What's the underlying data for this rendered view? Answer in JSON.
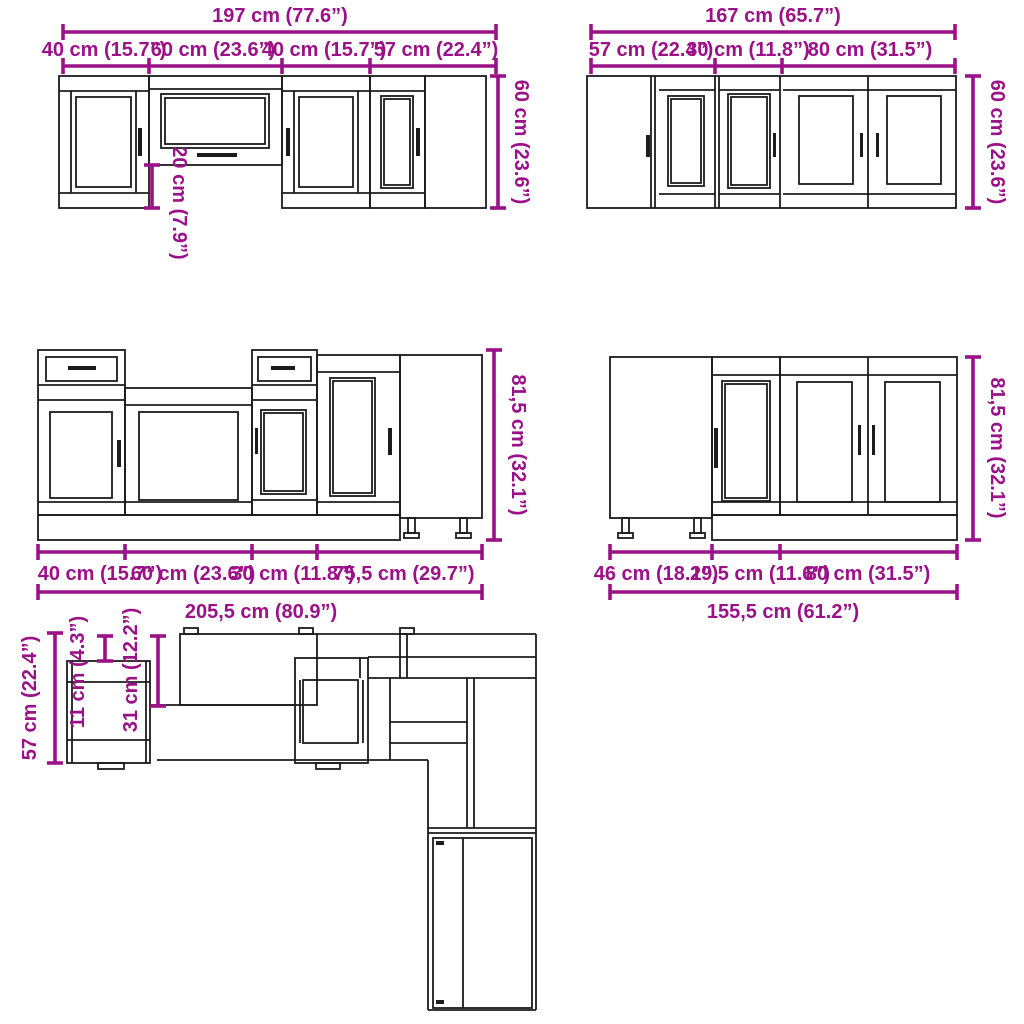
{
  "page": {
    "background_color": "#ffffff",
    "dimension_color": "#9b1188",
    "line_color": "#1c1c1c"
  },
  "panels": {
    "wall_run_left": {
      "total_width": "197 cm (77.6”)",
      "segments": [
        "40 cm (15.7”)",
        "60 cm (23.6”)",
        "40 cm (15.7”)",
        "57 cm (22.4”)"
      ],
      "height": "60 cm (23.6”)",
      "drop": "20 cm (7.9”)"
    },
    "wall_run_right": {
      "total_width": "167 cm (65.7”)",
      "segments": [
        "57 cm (22.4”)",
        "30 cm (11.8”)",
        "80 cm (31.5”)"
      ],
      "height": "60 cm (23.6”)"
    },
    "base_run_left": {
      "segments": [
        "40 cm (15.7”)",
        "60 cm (23.6”)",
        "30 cm (11.8”)",
        "75,5 cm (29.7”)"
      ],
      "total_width": "205,5 cm (80.9”)",
      "height": "81,5 cm (32.1”)"
    },
    "base_run_right": {
      "segments": [
        "46 cm (18.1”)",
        "29,5 cm (11.6”)",
        "80 cm (31.5”)"
      ],
      "total_width": "155,5 cm (61.2”)",
      "height": "81,5 cm (32.1”)"
    },
    "plan_view": {
      "depth_total": "57 cm (22.4”)",
      "depth_small": "11 cm (4.3”)",
      "depth_medium": "31 cm (12.2”)"
    }
  }
}
